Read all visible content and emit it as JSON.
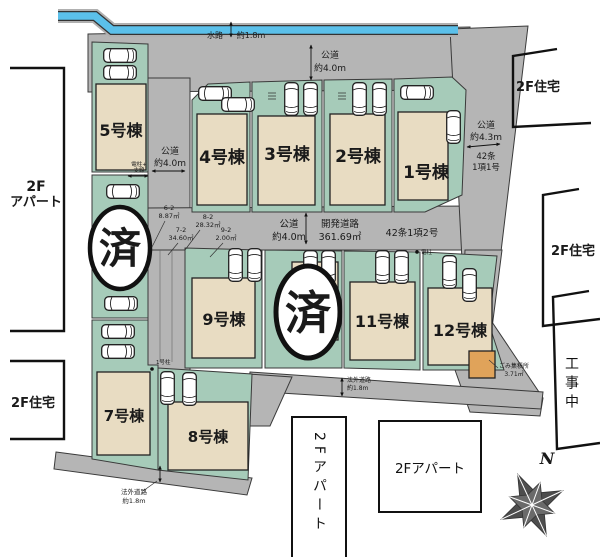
{
  "buildings": [
    "5号棟",
    "4号棟",
    "3号棟",
    "2号棟",
    "1号棟",
    "9号棟",
    "11号棟",
    "12号棟",
    "7号棟",
    "8号棟"
  ],
  "sold": "済",
  "waterway": [
    "水路",
    "約1.8m"
  ],
  "roads": {
    "north": [
      "公道",
      "約4.0m"
    ],
    "west": [
      "公道",
      "約4.0m"
    ],
    "center": [
      "公道",
      "約4.0m"
    ],
    "center_dev": [
      "開発道路",
      "361.69㎡"
    ],
    "center_law": "42条1項2号",
    "east": [
      "公道",
      "約4.3m"
    ],
    "east_law": [
      "42条",
      "1項1号"
    ],
    "south_mid": [
      "法外道路",
      "約1.8m"
    ],
    "south_left": [
      "法外道路",
      "約1.8m"
    ]
  },
  "parcels": [
    [
      "6-2",
      "8.87㎡"
    ],
    [
      "8-2",
      "28.32㎡"
    ],
    [
      "7-2",
      "34.60㎡"
    ],
    [
      "9-2",
      "2.00㎡"
    ]
  ],
  "markers": {
    "pole_guy": [
      "電柱+",
      "支線"
    ],
    "pole_no1": "1号柱",
    "pole": "電柱",
    "garbage": [
      "ごみ集積所",
      "3.71㎡"
    ]
  },
  "neighbors": {
    "apartment_left": [
      "2F",
      "アパート"
    ],
    "house_sw": "2F住宅",
    "house_ne": "2F住宅",
    "house_e": "2F住宅",
    "construction": "工事中",
    "apartment_s_tall": "2Fアパート",
    "apartment_s_box": "2Fアパート"
  },
  "compass_n": "N",
  "colors": {
    "road": "#b5b5b5",
    "lot": "#a6cbb9",
    "building": "#e8dcc2",
    "water": "#5bc0ea",
    "garbage": "#e0a35a",
    "outline": "#222222"
  }
}
